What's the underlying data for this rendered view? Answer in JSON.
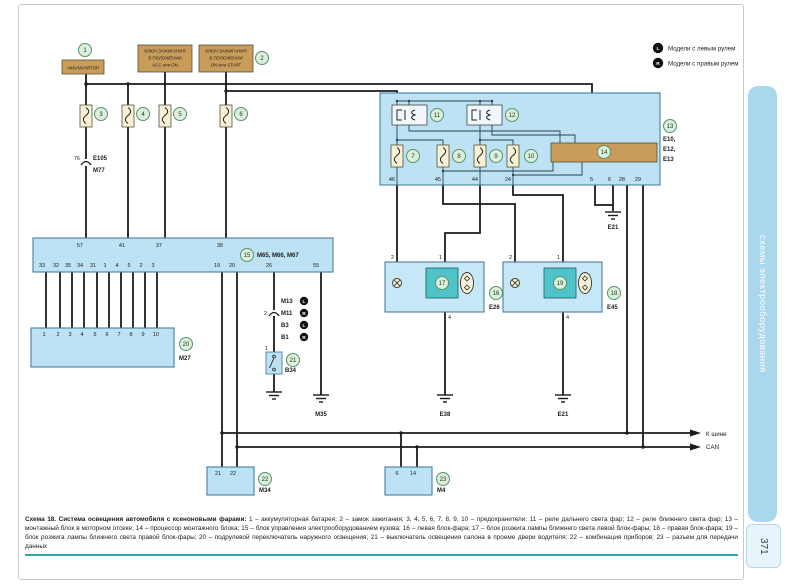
{
  "page": {
    "sidebar": "схемы электрооборудования",
    "number": "371"
  },
  "legend": {
    "items": [
      {
        "badge": "L",
        "label": "Модели с левым рулем"
      },
      {
        "badge": "R",
        "label": "Модели с правым рулем"
      }
    ]
  },
  "battery": {
    "num": "1",
    "label": "АККУМУЛЯТОР"
  },
  "key_acc": {
    "l1": "КЛЮЧ ЗАЖИГАНИЯ",
    "l2": "В ПОЛОЖЕНИИ",
    "l3": "ACC или ON"
  },
  "key_on": {
    "num": "2",
    "l1": "КЛЮЧ ЗАЖИГАНИЯ",
    "l2": "В ПОЛОЖЕНИИ",
    "l3": "ON или START"
  },
  "fuses": {
    "f3": "3",
    "f4": "4",
    "f5": "5",
    "f6": "6",
    "f7": "7",
    "f8": "8",
    "f9": "9",
    "f10": "10"
  },
  "e105": {
    "pin": "76",
    "top": "E105",
    "bottom": "M77"
  },
  "mount": {
    "num": "13",
    "refs": [
      "E10,",
      "E12,",
      "E13"
    ],
    "relay1": "11",
    "relay2": "12",
    "cpu": "14",
    "pins": [
      "46",
      "45",
      "44",
      "24",
      "5",
      "6",
      "28",
      "29"
    ],
    "ground": "E21"
  },
  "bcm": {
    "num": "15",
    "name": "M65, M66, M67",
    "top": [
      "57",
      "41",
      "37",
      "38"
    ],
    "bottom": [
      "33",
      "32",
      "35",
      "34",
      "31",
      "1",
      "4",
      "5",
      "2",
      "3",
      "19",
      "20",
      "26",
      "55"
    ]
  },
  "m27": {
    "num": "20",
    "name": "M27",
    "pins": [
      "1",
      "2",
      "3",
      "4",
      "5",
      "6",
      "7",
      "8",
      "9",
      "10"
    ]
  },
  "hl_left": {
    "num": "16",
    "name": "E26",
    "ign": "17",
    "pin2": "2",
    "pin1": "1",
    "pin4": "4",
    "ground": "E38"
  },
  "hl_right": {
    "num": "18",
    "name": "E45",
    "ign": "19",
    "pin2": "2",
    "pin1": "1",
    "pin4": "4",
    "ground": "E21"
  },
  "m34": {
    "num": "22",
    "name": "M34",
    "pins": [
      "21",
      "22"
    ]
  },
  "m4": {
    "num": "23",
    "name": "M4",
    "pins": [
      "6",
      "14"
    ]
  },
  "door": {
    "num": "21",
    "name": "B34",
    "pin_top": "2",
    "pin_in": "1",
    "conns": [
      {
        "name": "M13",
        "side": "L"
      },
      {
        "name": "M11",
        "side": "R"
      },
      {
        "name": "B3",
        "side": "L"
      },
      {
        "name": "B1",
        "side": "R"
      }
    ]
  },
  "grounds": {
    "m35": "M35"
  },
  "can": {
    "l1": "К шине",
    "l2": "CAN"
  },
  "caption": {
    "title": "Схема 18. Система освещения автомобиля с ксеноновыми фарами:",
    "body": "1 – аккумуляторная батарея; 2 – замок зажигания; 3, 4, 5, 6, 7, 8, 9, 10 – предохранители; 11 – реле дальнего света фар; 12 – реле ближнего света фар; 13 – монтажный блок в моторном отсеке; 14 – процессор монтажного блока; 15 – блок управления электрооборудованием кузова; 16 – левая блок-фара; 17 – блок розжига лампы ближнего света левой блок-фары; 18 – правая блок-фара; 19 – блок розжига лампы ближнего света правой блок-фары; 20 – подрулевой переключатель наружного освещения; 21 – выключатель освещения салона в проеме двери водителя; 22 – комбинация приборов; 23 – разъем для передачи данных"
  }
}
